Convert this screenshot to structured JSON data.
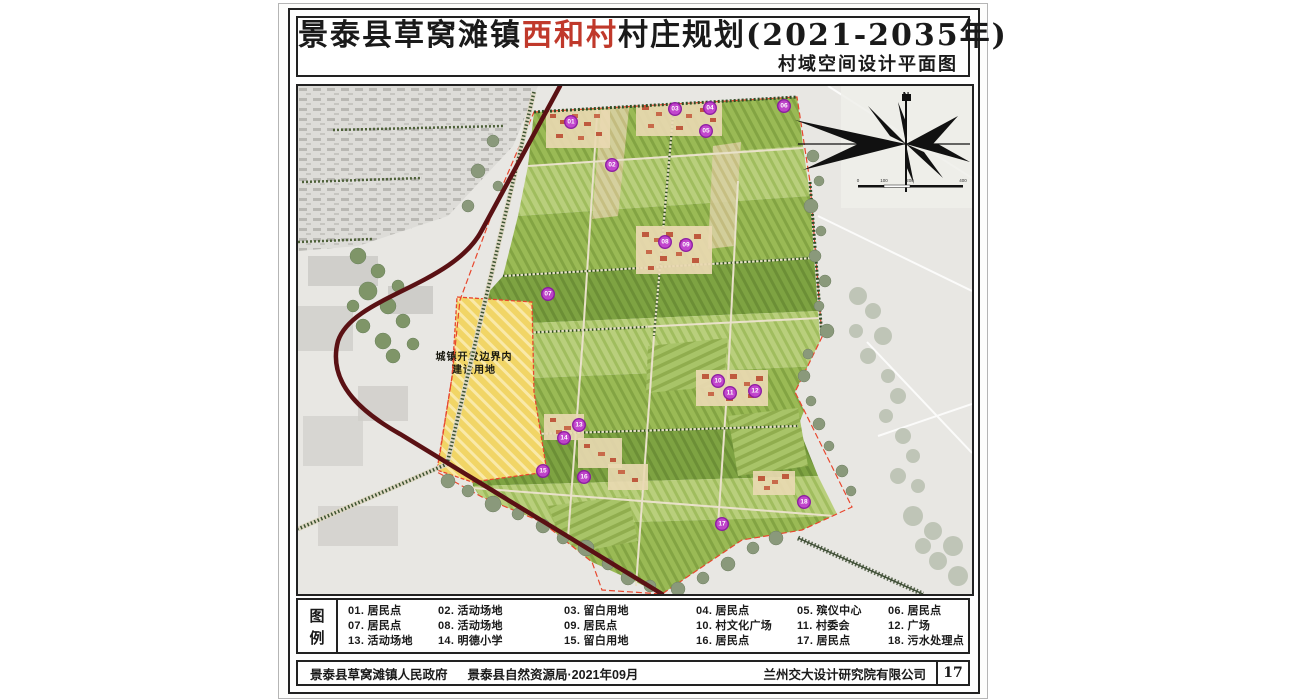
{
  "title": {
    "prefix": "景泰县草窝滩镇",
    "highlight": "西和村",
    "suffix": "村庄规划(2021-2035年)",
    "subtitle": "村域空间设计平面图",
    "highlight_color": "#c0392b"
  },
  "map": {
    "development_label": {
      "line1": "城镇开发边界内",
      "line2": "建设用地"
    },
    "compass_n": "N",
    "scale_labels": [
      "0",
      "100",
      "200",
      "400"
    ],
    "markers": [
      {
        "num": "01",
        "x": 273,
        "y": 36
      },
      {
        "num": "02",
        "x": 314,
        "y": 79
      },
      {
        "num": "03",
        "x": 377,
        "y": 23
      },
      {
        "num": "04",
        "x": 412,
        "y": 22
      },
      {
        "num": "05",
        "x": 408,
        "y": 45
      },
      {
        "num": "06",
        "x": 486,
        "y": 20
      },
      {
        "num": "07",
        "x": 250,
        "y": 208
      },
      {
        "num": "08",
        "x": 367,
        "y": 156
      },
      {
        "num": "09",
        "x": 388,
        "y": 159
      },
      {
        "num": "10",
        "x": 420,
        "y": 295
      },
      {
        "num": "11",
        "x": 432,
        "y": 307
      },
      {
        "num": "12",
        "x": 457,
        "y": 305
      },
      {
        "num": "13",
        "x": 281,
        "y": 339
      },
      {
        "num": "14",
        "x": 266,
        "y": 352
      },
      {
        "num": "15",
        "x": 245,
        "y": 385
      },
      {
        "num": "16",
        "x": 286,
        "y": 391
      },
      {
        "num": "17",
        "x": 424,
        "y": 438
      },
      {
        "num": "18",
        "x": 506,
        "y": 416
      }
    ]
  },
  "legend": {
    "title_top": "图",
    "title_bottom": "例",
    "items": [
      "01. 居民点",
      "02. 活动场地",
      "03. 留白用地",
      "04. 居民点",
      "05. 殡仪中心",
      "06. 居民点",
      "07. 居民点",
      "08. 活动场地",
      "09. 居民点",
      "10. 村文化广场",
      "11. 村委会",
      "12. 广场",
      "13. 活动场地",
      "14. 明德小学",
      "15. 留白用地",
      "16. 居民点",
      "17. 居民点",
      "18. 污水处理点"
    ]
  },
  "footer": {
    "org1": "景泰县草窝滩镇人民政府",
    "org2": "景泰县自然资源局·2021年09月",
    "right": "兰州交大设计研究院有限公司",
    "page": "17"
  },
  "colors": {
    "highlight_red": "#c0392b",
    "boundary_red": "#e8472e",
    "road_maroon": "#5a1114",
    "field_green": "#9aba55",
    "development_yellow": "#f1d566",
    "marker_purple": "#c13fd0",
    "tree_green": "#33531f"
  }
}
